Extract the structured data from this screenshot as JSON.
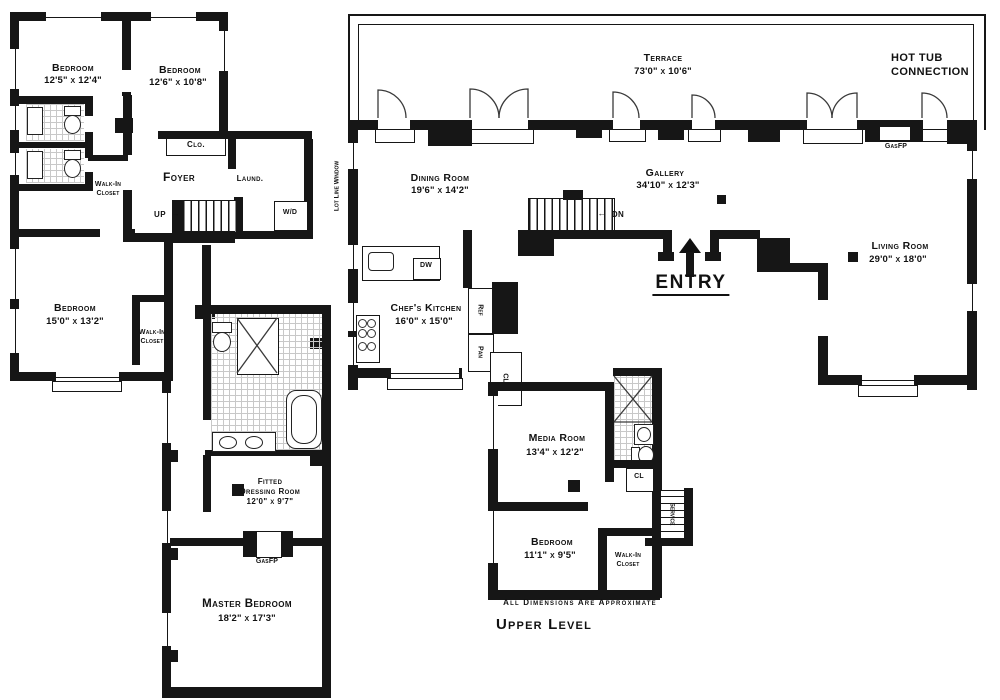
{
  "upper_title": "Upper Level",
  "disclaimer": "All Dimensions Are Approximate",
  "icons": {
    "up_arrow": "→",
    "down_arrow": "←"
  },
  "lower": {
    "bedroom1": {
      "name": "Bedroom",
      "dims": "12'5\" x 12'4\""
    },
    "bedroom2": {
      "name": "Bedroom",
      "dims": "12'6\" x 10'8\""
    },
    "bedroom3": {
      "name": "Bedroom",
      "dims": "15'0\" x 13'2\""
    },
    "master_bedroom": {
      "name": "Master Bedroom",
      "dims": "18'2\" x 17'3\""
    },
    "dressing_room": {
      "name": "Fitted",
      "name2": "Dressing Room",
      "dims": "12'0\" x 9'7\""
    },
    "foyer": "Foyer",
    "closet": "Clo.",
    "laundry": "Laund.",
    "washer_dryer": "W/D",
    "walk_in_closet_1": {
      "line1": "Walk-In",
      "line2": "Closet"
    },
    "walk_in_closet_2": {
      "line1": "Walk-In",
      "line2": "Closet"
    },
    "gas_fireplace": "GasFP",
    "up": "UP"
  },
  "upper": {
    "terrace": {
      "name": "Terrace",
      "dims": "73'0\" x 10'6\""
    },
    "dining_room": {
      "name": "Dining Room",
      "dims": "19'6\" x 14'2\""
    },
    "gallery": {
      "name": "Gallery",
      "dims": "34'10\" x 12'3\""
    },
    "living_room": {
      "name": "Living Room",
      "dims": "29'0\" x 18'0\""
    },
    "kitchen": {
      "name": "Chef's Kitchen",
      "dims": "16'0\" x 15'0\""
    },
    "media_room": {
      "name": "Media Room",
      "dims": "13'4\" x 12'2\""
    },
    "bedroom": {
      "name": "Bedroom",
      "dims": "11'1\" x 9'5\""
    },
    "walk_in_closet": {
      "line1": "Walk-In",
      "line2": "Closet"
    },
    "entry": "ENTRY",
    "down": "DN",
    "gas_fireplace": "GasFP",
    "hot_tub": {
      "line1": "HOT TUB",
      "line2": "CONNECTION"
    },
    "lot_line_window": "Lot Line Window",
    "service": "Service",
    "dishwasher": "DW",
    "refrigerator": "Ref",
    "pantry": "Pan",
    "closet_1": "CL",
    "closet_2": "CL"
  }
}
